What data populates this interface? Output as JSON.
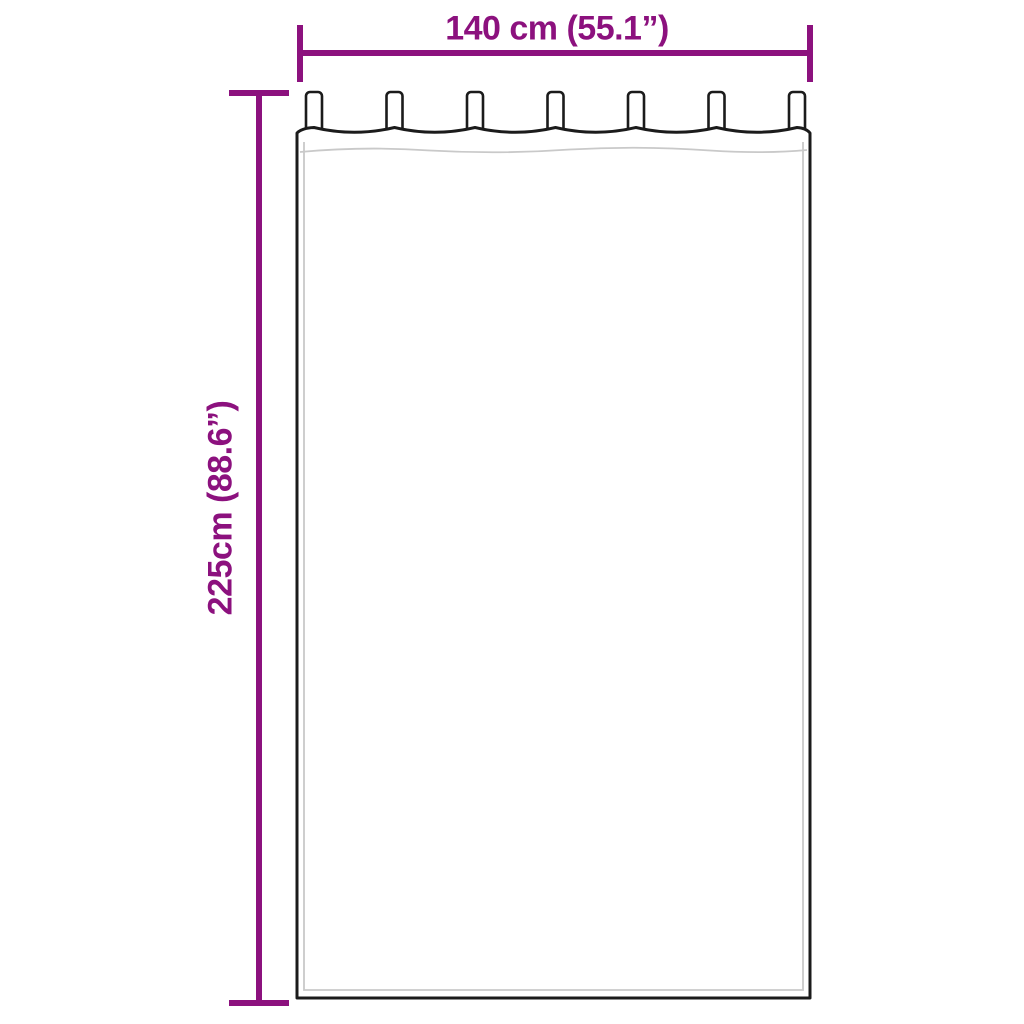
{
  "diagram": {
    "kind": "product-dimension-diagram",
    "subject": "tab-top curtain line drawing",
    "tab_count": 7,
    "width": {
      "label": "140 cm (55.1”)",
      "cm": 140,
      "inches": 55.1
    },
    "height": {
      "label": "225cm (88.6”)",
      "cm": 225,
      "inches": 88.6
    }
  },
  "colors": {
    "dimension_accent": "#8C117E",
    "outline": "#1b1b1b",
    "seam_gray": "#c9c9c9",
    "background": "#ffffff"
  }
}
